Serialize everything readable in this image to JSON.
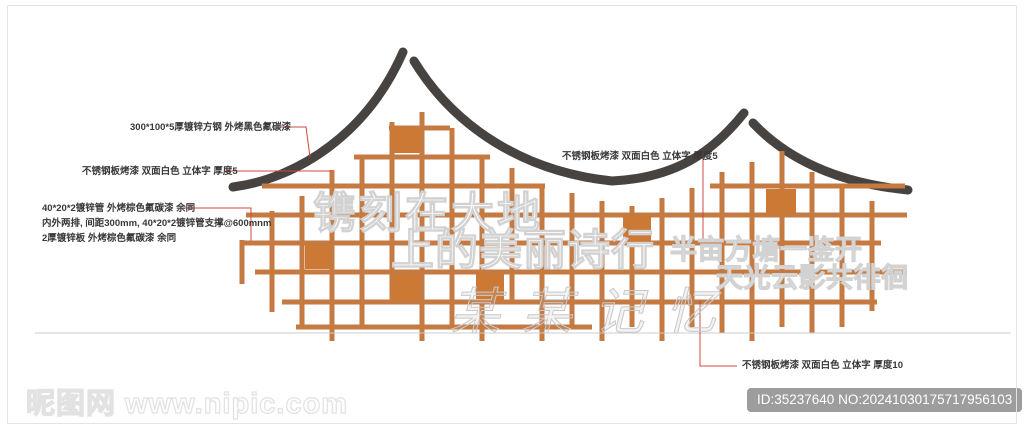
{
  "canvas": {
    "width": 1024,
    "height": 427,
    "background": "#ffffff"
  },
  "colors": {
    "roof": "#474340",
    "lattice_line": "#c57a42",
    "lattice_square": "#cd7936",
    "leader": "#cc4a44",
    "annotation_text": "#383838",
    "baseline": "#cccccc",
    "badge_bg": "#9d9d9d",
    "badge_text": "#ffffff",
    "watermark_outline": "#d2d2d2"
  },
  "annotations": [
    {
      "text": "300*100*5厚镀锌方钢 外烤黑色氟碳漆",
      "x": 130,
      "y": 120,
      "leader": [
        [
          281,
          127
        ],
        [
          306,
          127
        ],
        [
          310,
          157
        ]
      ]
    },
    {
      "text": "不锈钢板烤漆 双面白色 立体字 厚度5",
      "x": 82,
      "y": 164,
      "leader": [
        [
          224,
          171
        ],
        [
          331,
          171
        ]
      ]
    },
    {
      "lines": [
        "40*20*2镀锌管 外烤棕色氟碳漆 余同",
        "内外两排, 间距300mm, 40*20*2镀锌管支撑@600mnm",
        "2厚镀锌板 外烤棕色氟碳漆 余同"
      ],
      "x": 42,
      "y": 201,
      "leader": [
        [
          185,
          208
        ],
        [
          251,
          208
        ],
        [
          251,
          241
        ]
      ]
    },
    {
      "text": "不锈钢板烤漆 双面白色 立体字 厚度5",
      "x": 562,
      "y": 149,
      "leader": [
        [
          703,
          158
        ],
        [
          703,
          240
        ]
      ]
    },
    {
      "text": "不锈钢板烤漆 双面白色 立体字 厚度10",
      "x": 742,
      "y": 358,
      "leader": [
        [
          737,
          366
        ],
        [
          700,
          366
        ],
        [
          700,
          300
        ]
      ]
    }
  ],
  "artwork_text": {
    "slogan_line1": "镌刻在大地",
    "slogan_line2": "上的美丽诗行",
    "poem_line1": "半亩方塘一鉴开",
    "poem_line2": "天光云影共徘徊",
    "script_watermark": "某某记忆"
  },
  "watermarks": {
    "site": "昵图网 www.nipic.com",
    "badge": "ID:35237640 NO:20241030175717956103"
  },
  "drawing": {
    "roof": {
      "stroke_width": 9,
      "paths": [
        "M 233 187 C 300 178, 368 132, 403 52",
        "M 414 61 C 455 128, 525 172, 612 181 C 675 178, 712 153, 744 113",
        "M 753 123 C 788 160, 838 183, 908 190"
      ]
    },
    "lattice": {
      "stroke_width": 5,
      "h": [
        [
          128,
          389,
          450
        ],
        [
          157,
          354,
          490
        ],
        [
          186,
          262,
          545
        ],
        [
          186,
          710,
          905
        ],
        [
          215,
          246,
          907
        ],
        [
          243,
          241,
          881
        ],
        [
          272,
          255,
          907
        ],
        [
          302,
          282,
          877
        ],
        [
          327,
          296,
          592
        ]
      ],
      "v": [
        [
          242,
          240,
          284
        ],
        [
          272,
          211,
          312
        ],
        [
          302,
          196,
          327
        ],
        [
          332,
          170,
          341
        ],
        [
          362,
          157,
          327
        ],
        [
          392,
          122,
          302
        ],
        [
          422,
          112,
          341
        ],
        [
          452,
          128,
          327
        ],
        [
          482,
          157,
          341
        ],
        [
          512,
          168,
          302
        ],
        [
          542,
          186,
          341
        ],
        [
          572,
          193,
          327
        ],
        [
          602,
          201,
          341
        ],
        [
          632,
          206,
          327
        ],
        [
          662,
          198,
          341
        ],
        [
          692,
          188,
          327
        ],
        [
          722,
          172,
          333
        ],
        [
          752,
          162,
          341
        ],
        [
          782,
          151,
          327
        ],
        [
          812,
          172,
          333
        ],
        [
          842,
          186,
          327
        ],
        [
          872,
          201,
          311
        ]
      ]
    },
    "squares": [
      [
        391,
        127,
        29,
        26
      ],
      [
        305,
        245,
        26,
        24
      ],
      [
        392,
        274,
        28,
        27
      ],
      [
        476,
        274,
        28,
        27
      ],
      [
        623,
        216,
        28,
        26
      ],
      [
        766,
        189,
        30,
        25
      ]
    ],
    "baseline": [
      35,
      333,
      1011,
      333
    ]
  }
}
